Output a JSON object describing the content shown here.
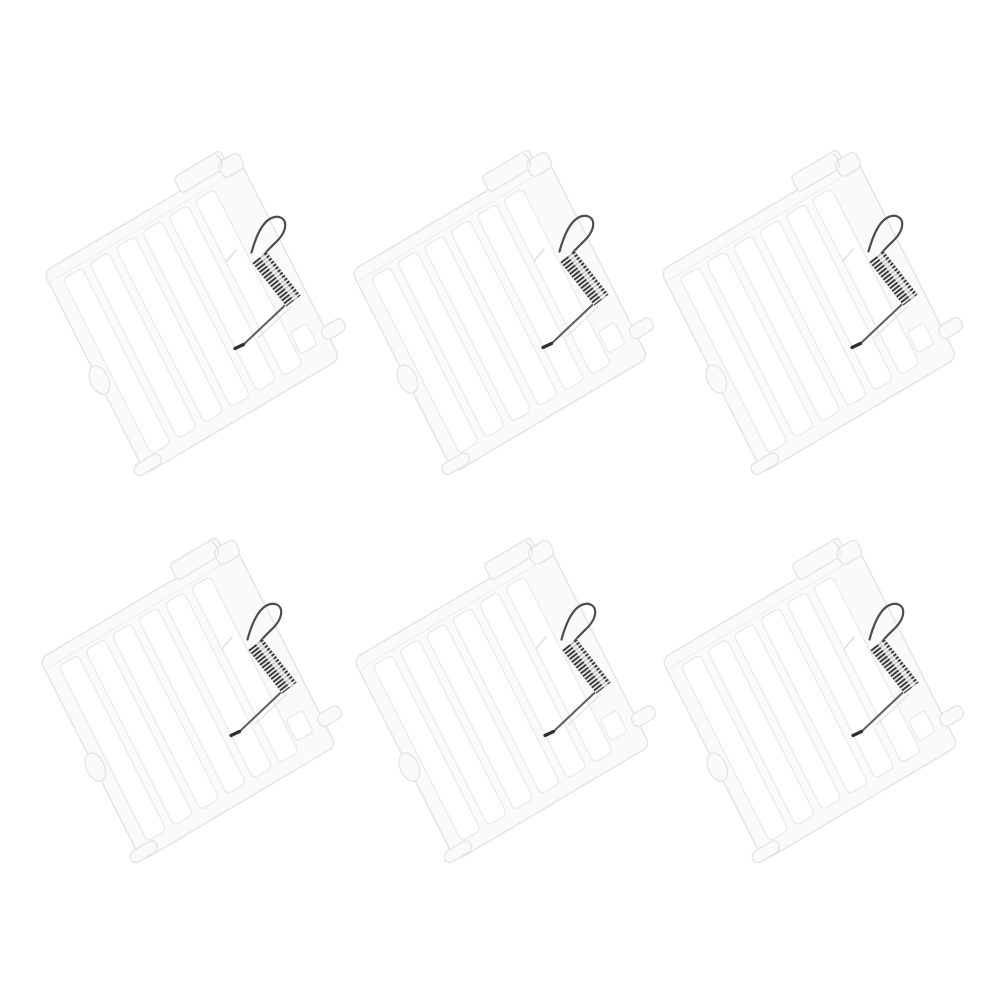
{
  "canvas": {
    "width": 1002,
    "height": 1002,
    "background": "#ffffff"
  },
  "collage": {
    "kind": "product-photo-collage",
    "item_name": "white-rack-panel-with-tension-spring",
    "item_count": 6,
    "grid": {
      "rows": 2,
      "cols": 3
    },
    "positions": [
      {
        "x": 30,
        "y": 125
      },
      {
        "x": 338,
        "y": 124
      },
      {
        "x": 647,
        "y": 124
      },
      {
        "x": 26,
        "y": 512
      },
      {
        "x": 340,
        "y": 512
      },
      {
        "x": 648,
        "y": 512
      }
    ],
    "item_parts": [
      "slatted-grid-panel",
      "top-rail",
      "top-hook-tab",
      "left-side-foot",
      "bottom-rail-cap",
      "corner-tab",
      "slot-cutout",
      "tension-spring-coil",
      "spring-hook",
      "spring-leg-wire"
    ]
  },
  "colors": {
    "background": "#ffffff",
    "plastic_fill": "#fafafa",
    "plastic_edge": "#e5e5e5",
    "hole_fill": "#ffffff",
    "hole_edge": "#ebebeb",
    "detail_line": "#efefef",
    "spring_coil_dark": "#3a3a3a",
    "spring_hook_wire": "#4d4d4d",
    "spring_leg_wire": "#5e5e5e",
    "spring_tip": "#2f2f2f",
    "spring_coil_base": "#e9e9e9",
    "shadow_line": "#e0e0e0"
  }
}
